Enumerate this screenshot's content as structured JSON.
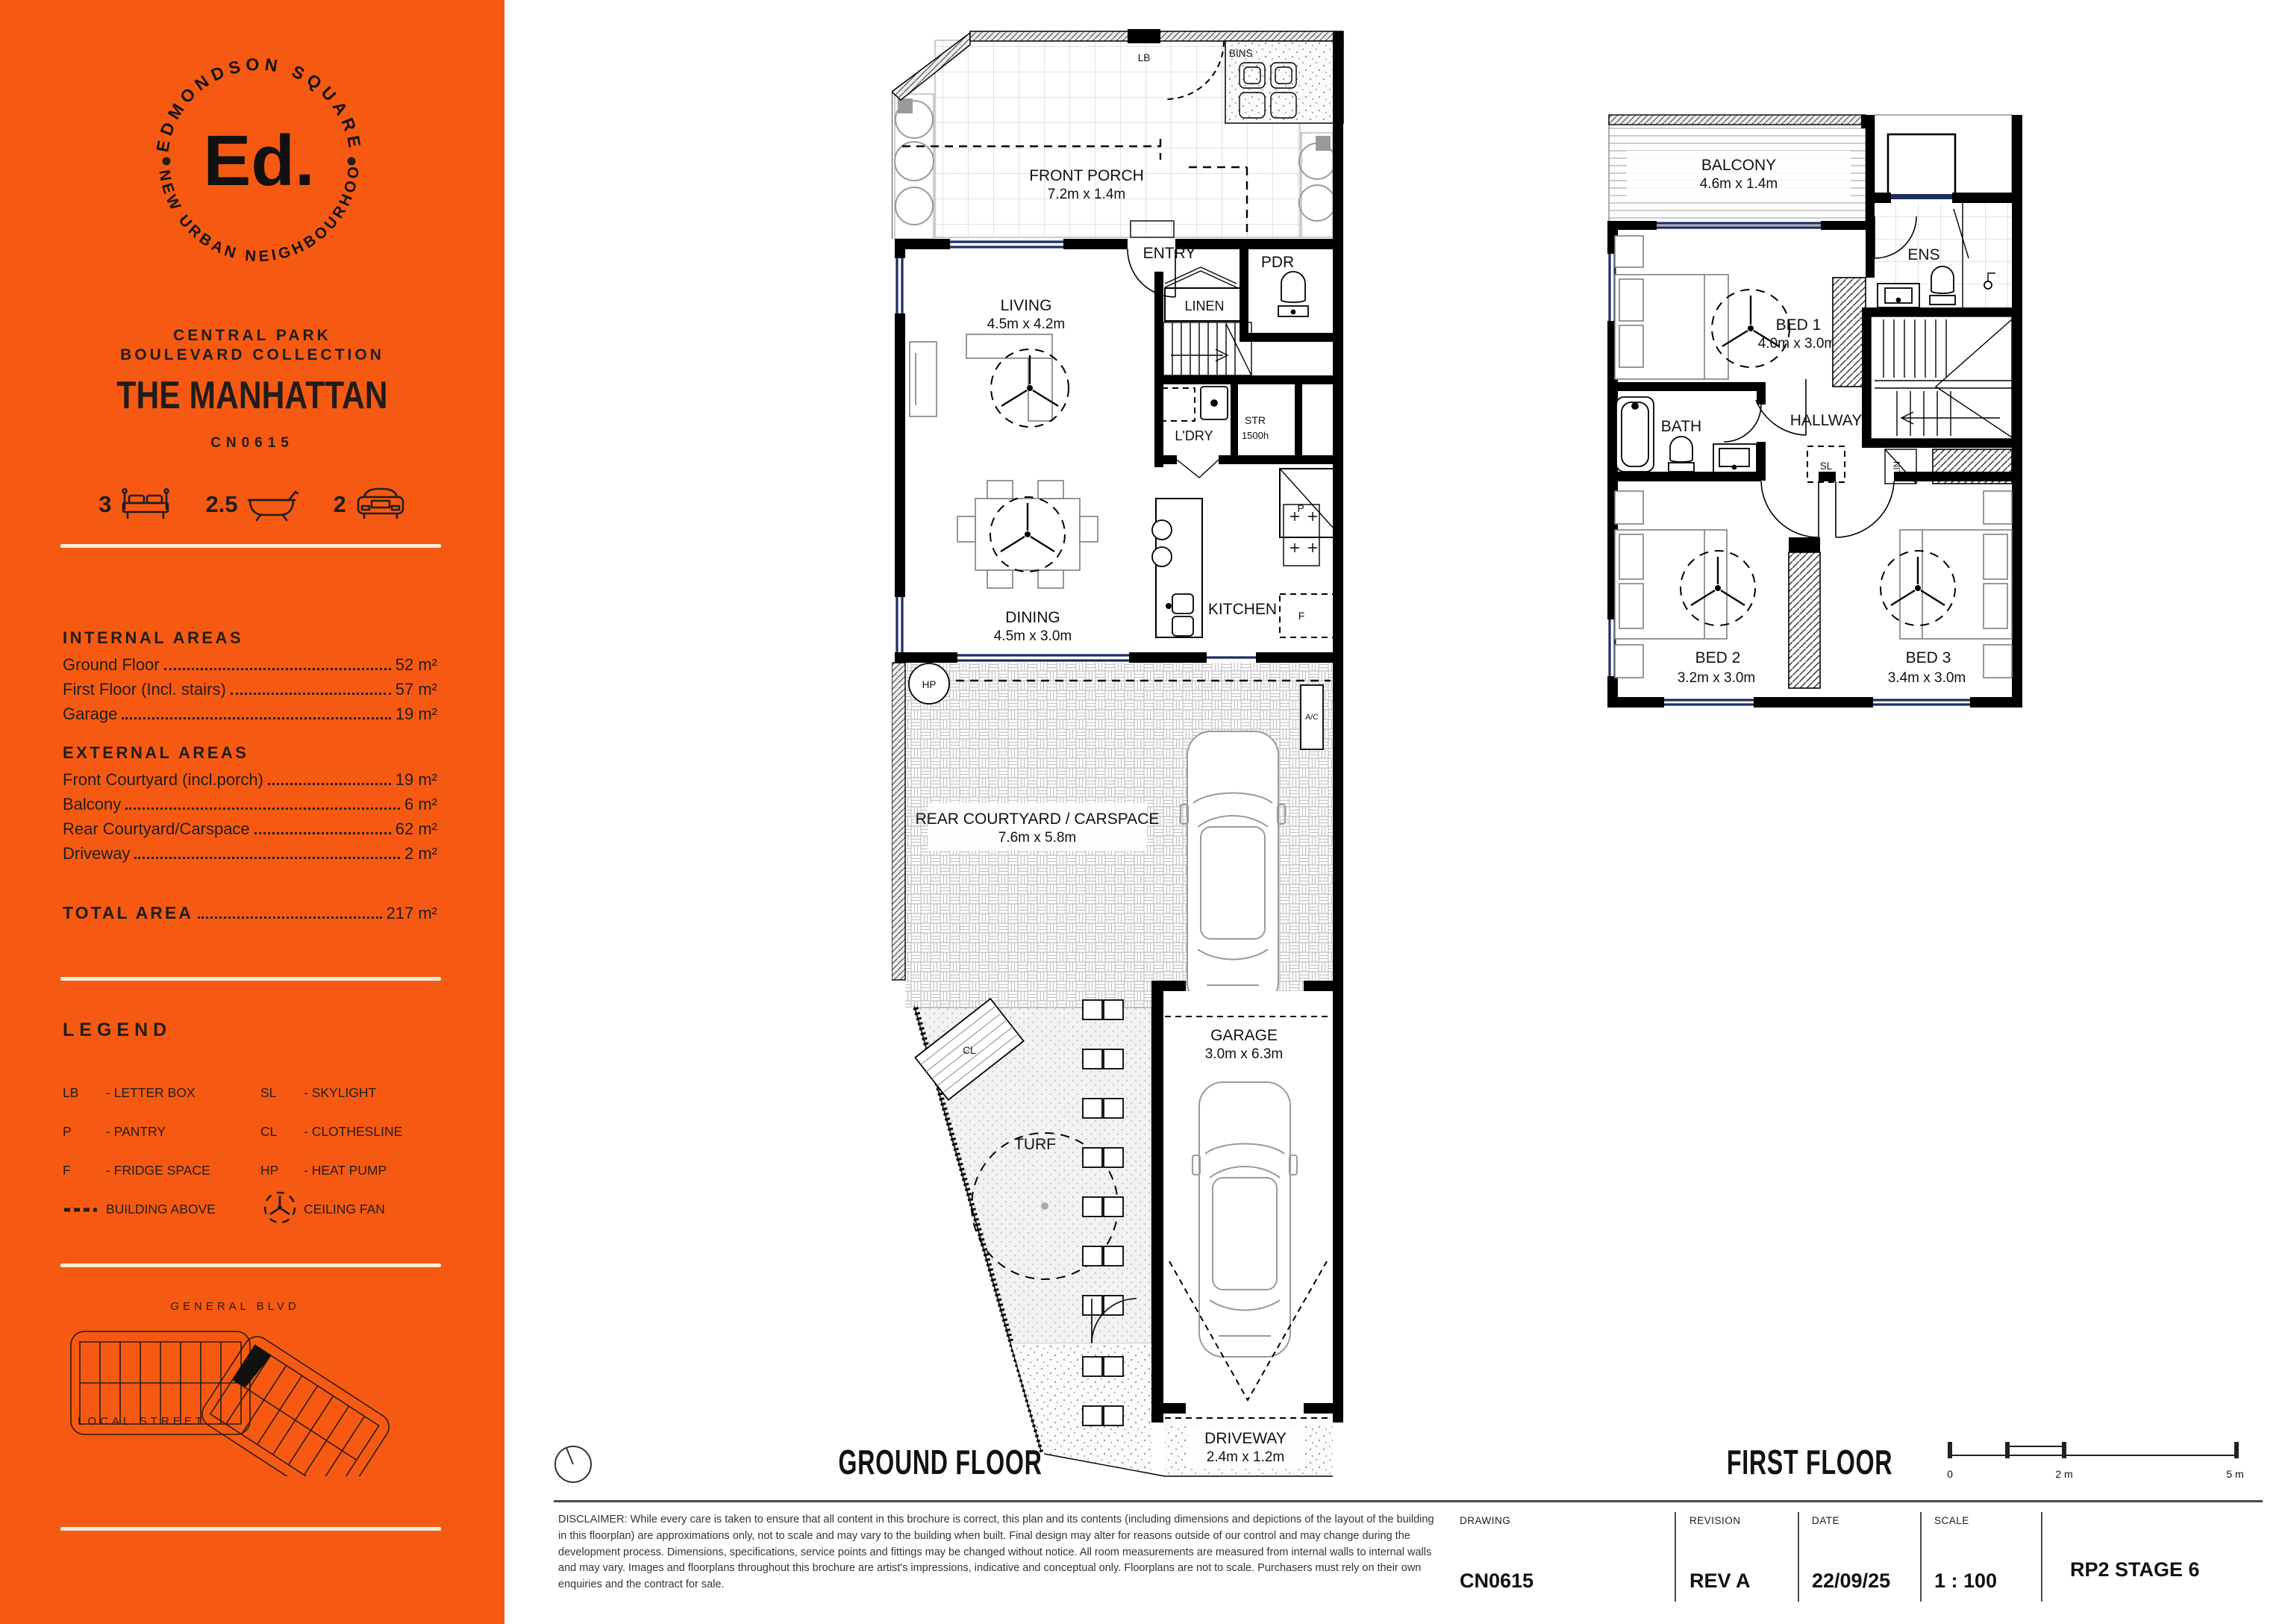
{
  "colors": {
    "orange": "#F65A12",
    "cream": "#F5EEDA",
    "ink": "#201D1A",
    "window_navy": "#1E2D63"
  },
  "sidebar": {
    "logo": {
      "arc_top": "EDMONDSON SQUARE",
      "arc_bottom": "A NEW URBAN NEIGHBOURHOOD",
      "mark": "Ed."
    },
    "collection": [
      "CENTRAL PARK",
      "BOULEVARD COLLECTION"
    ],
    "plan_name": "THE MANHATTAN",
    "plan_code": "CN0615",
    "stats": {
      "beds": "3",
      "baths": "2.5",
      "cars": "2"
    },
    "internal": {
      "heading": "INTERNAL AREAS",
      "rows": [
        {
          "label": "Ground Floor",
          "value": "52 m²"
        },
        {
          "label": "First Floor (Incl. stairs)",
          "value": "57 m²"
        },
        {
          "label": "Garage",
          "value": "19 m²"
        }
      ]
    },
    "external": {
      "heading": "EXTERNAL AREAS",
      "rows": [
        {
          "label": "Front Courtyard (incl.porch)",
          "value": "19 m²"
        },
        {
          "label": "Balcony",
          "value": "6 m²"
        },
        {
          "label": "Rear Courtyard/Carspace",
          "value": "62 m²"
        },
        {
          "label": "Driveway",
          "value": "2 m²"
        }
      ]
    },
    "total": {
      "label": "TOTAL AREA",
      "value": "217 m²"
    },
    "legend": {
      "heading": "LEGEND",
      "left": [
        {
          "abbr": "LB",
          "desc": "- LETTER BOX"
        },
        {
          "abbr": "P",
          "desc": "- PANTRY"
        },
        {
          "abbr": "F",
          "desc": "- FRIDGE SPACE"
        },
        {
          "abbr": "",
          "desc": "BUILDING ABOVE"
        }
      ],
      "right": [
        {
          "abbr": "SL",
          "desc": "- SKYLIGHT"
        },
        {
          "abbr": "CL",
          "desc": "- CLOTHESLINE"
        },
        {
          "abbr": "HP",
          "desc": "- HEAT PUMP"
        },
        {
          "abbr": "",
          "desc": "CEILING FAN"
        }
      ]
    },
    "map": {
      "top_street": "GENERAL BLVD",
      "bottom_street": "LOCAL STREET"
    }
  },
  "ground": {
    "title": "GROUND FLOOR",
    "rooms": {
      "front_porch_name": "FRONT PORCH",
      "front_porch_dims": "7.2m x 1.4m",
      "lb": "LB",
      "bins": "BINS",
      "living_name": "LIVING",
      "living_dims": "4.5m x 4.2m",
      "entry": "ENTRY",
      "pdr": "PDR",
      "linen": "LINEN",
      "ldry": "L'DRY",
      "str": "STR",
      "str_h": "1500h",
      "p": "P",
      "f": "F",
      "hp": "HP",
      "ac": "A/C",
      "dining_name": "DINING",
      "dining_dims": "4.5m x 3.0m",
      "kitchen": "KITCHEN",
      "court_name": "REAR COURTYARD / CARSPACE",
      "court_dims": "7.6m x 5.8m",
      "cl": "CL",
      "turf": "TURF",
      "garage_name": "GARAGE",
      "garage_dims": "3.0m x 6.3m",
      "driveway_name": "DRIVEWAY",
      "driveway_dims": "2.4m x 1.2m"
    }
  },
  "first": {
    "title": "FIRST FLOOR",
    "rooms": {
      "balcony_name": "BALCONY",
      "balcony_dims": "4.6m x 1.4m",
      "bed1_name": "BED 1",
      "bed1_dims": "4.0m x 3.0m",
      "ens": "ENS",
      "bath": "BATH",
      "hallway": "HALLWAY",
      "sl": "SL",
      "lin": "LIN",
      "bed2_name": "BED 2",
      "bed2_dims": "3.2m x 3.0m",
      "bed3_name": "BED 3",
      "bed3_dims": "3.4m x 3.0m"
    }
  },
  "scalebar": {
    "zero": "0",
    "two": "2 m",
    "five": "5 m"
  },
  "titleblock": {
    "disclaimer": "DISCLAIMER: While every care is taken to ensure that all content in this brochure is correct, this plan and its contents (including dimensions and depictions of the layout of the building in this floorplan) are approximations only, not to scale and may vary to the building when built. Final design may alter for reasons outside of our control and may change during the development process. Dimensions, specifications, service points and fittings may be changed without notice. All room measurements are measured from internal walls to internal walls and may vary. Images and floorplans throughout this brochure are artist's impressions, indicative and conceptual only. Floorplans are not to scale. Purchasers must rely on their own enquiries and the contract for sale.",
    "cols": [
      {
        "label": "DRAWING",
        "value": "CN0615"
      },
      {
        "label": "REVISION",
        "value": "REV A"
      },
      {
        "label": "DATE",
        "value": "22/09/25"
      },
      {
        "label": "SCALE",
        "value": "1 : 100"
      }
    ],
    "stage": "RP2 STAGE 6"
  }
}
